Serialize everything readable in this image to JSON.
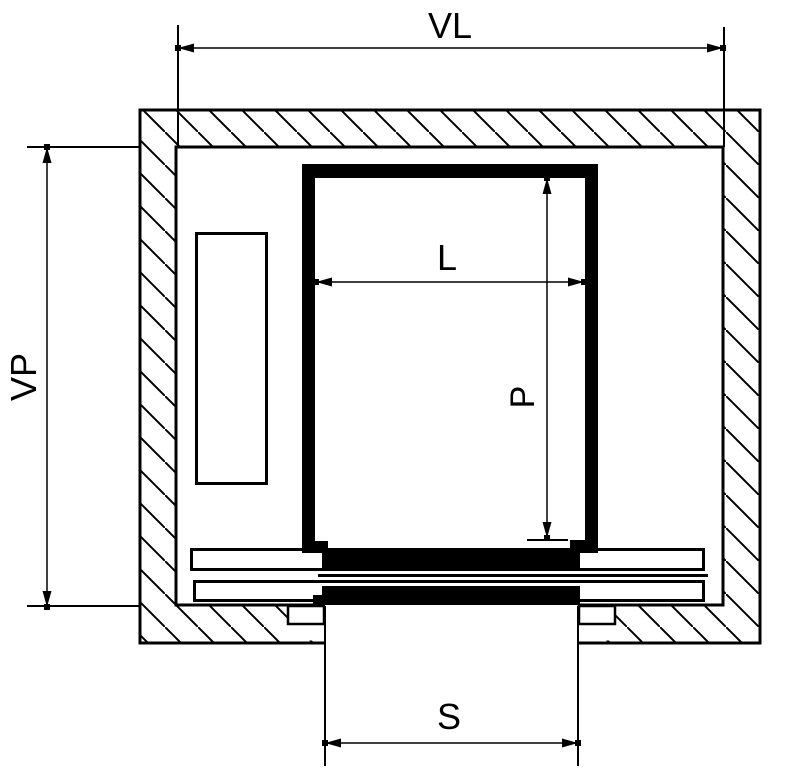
{
  "drawing": {
    "background": "#ffffff",
    "line_color": "#000000",
    "labels": {
      "shaft_width": "VL",
      "shaft_depth": "VP",
      "car_width": "L",
      "car_depth": "P",
      "door_width": "S"
    }
  }
}
